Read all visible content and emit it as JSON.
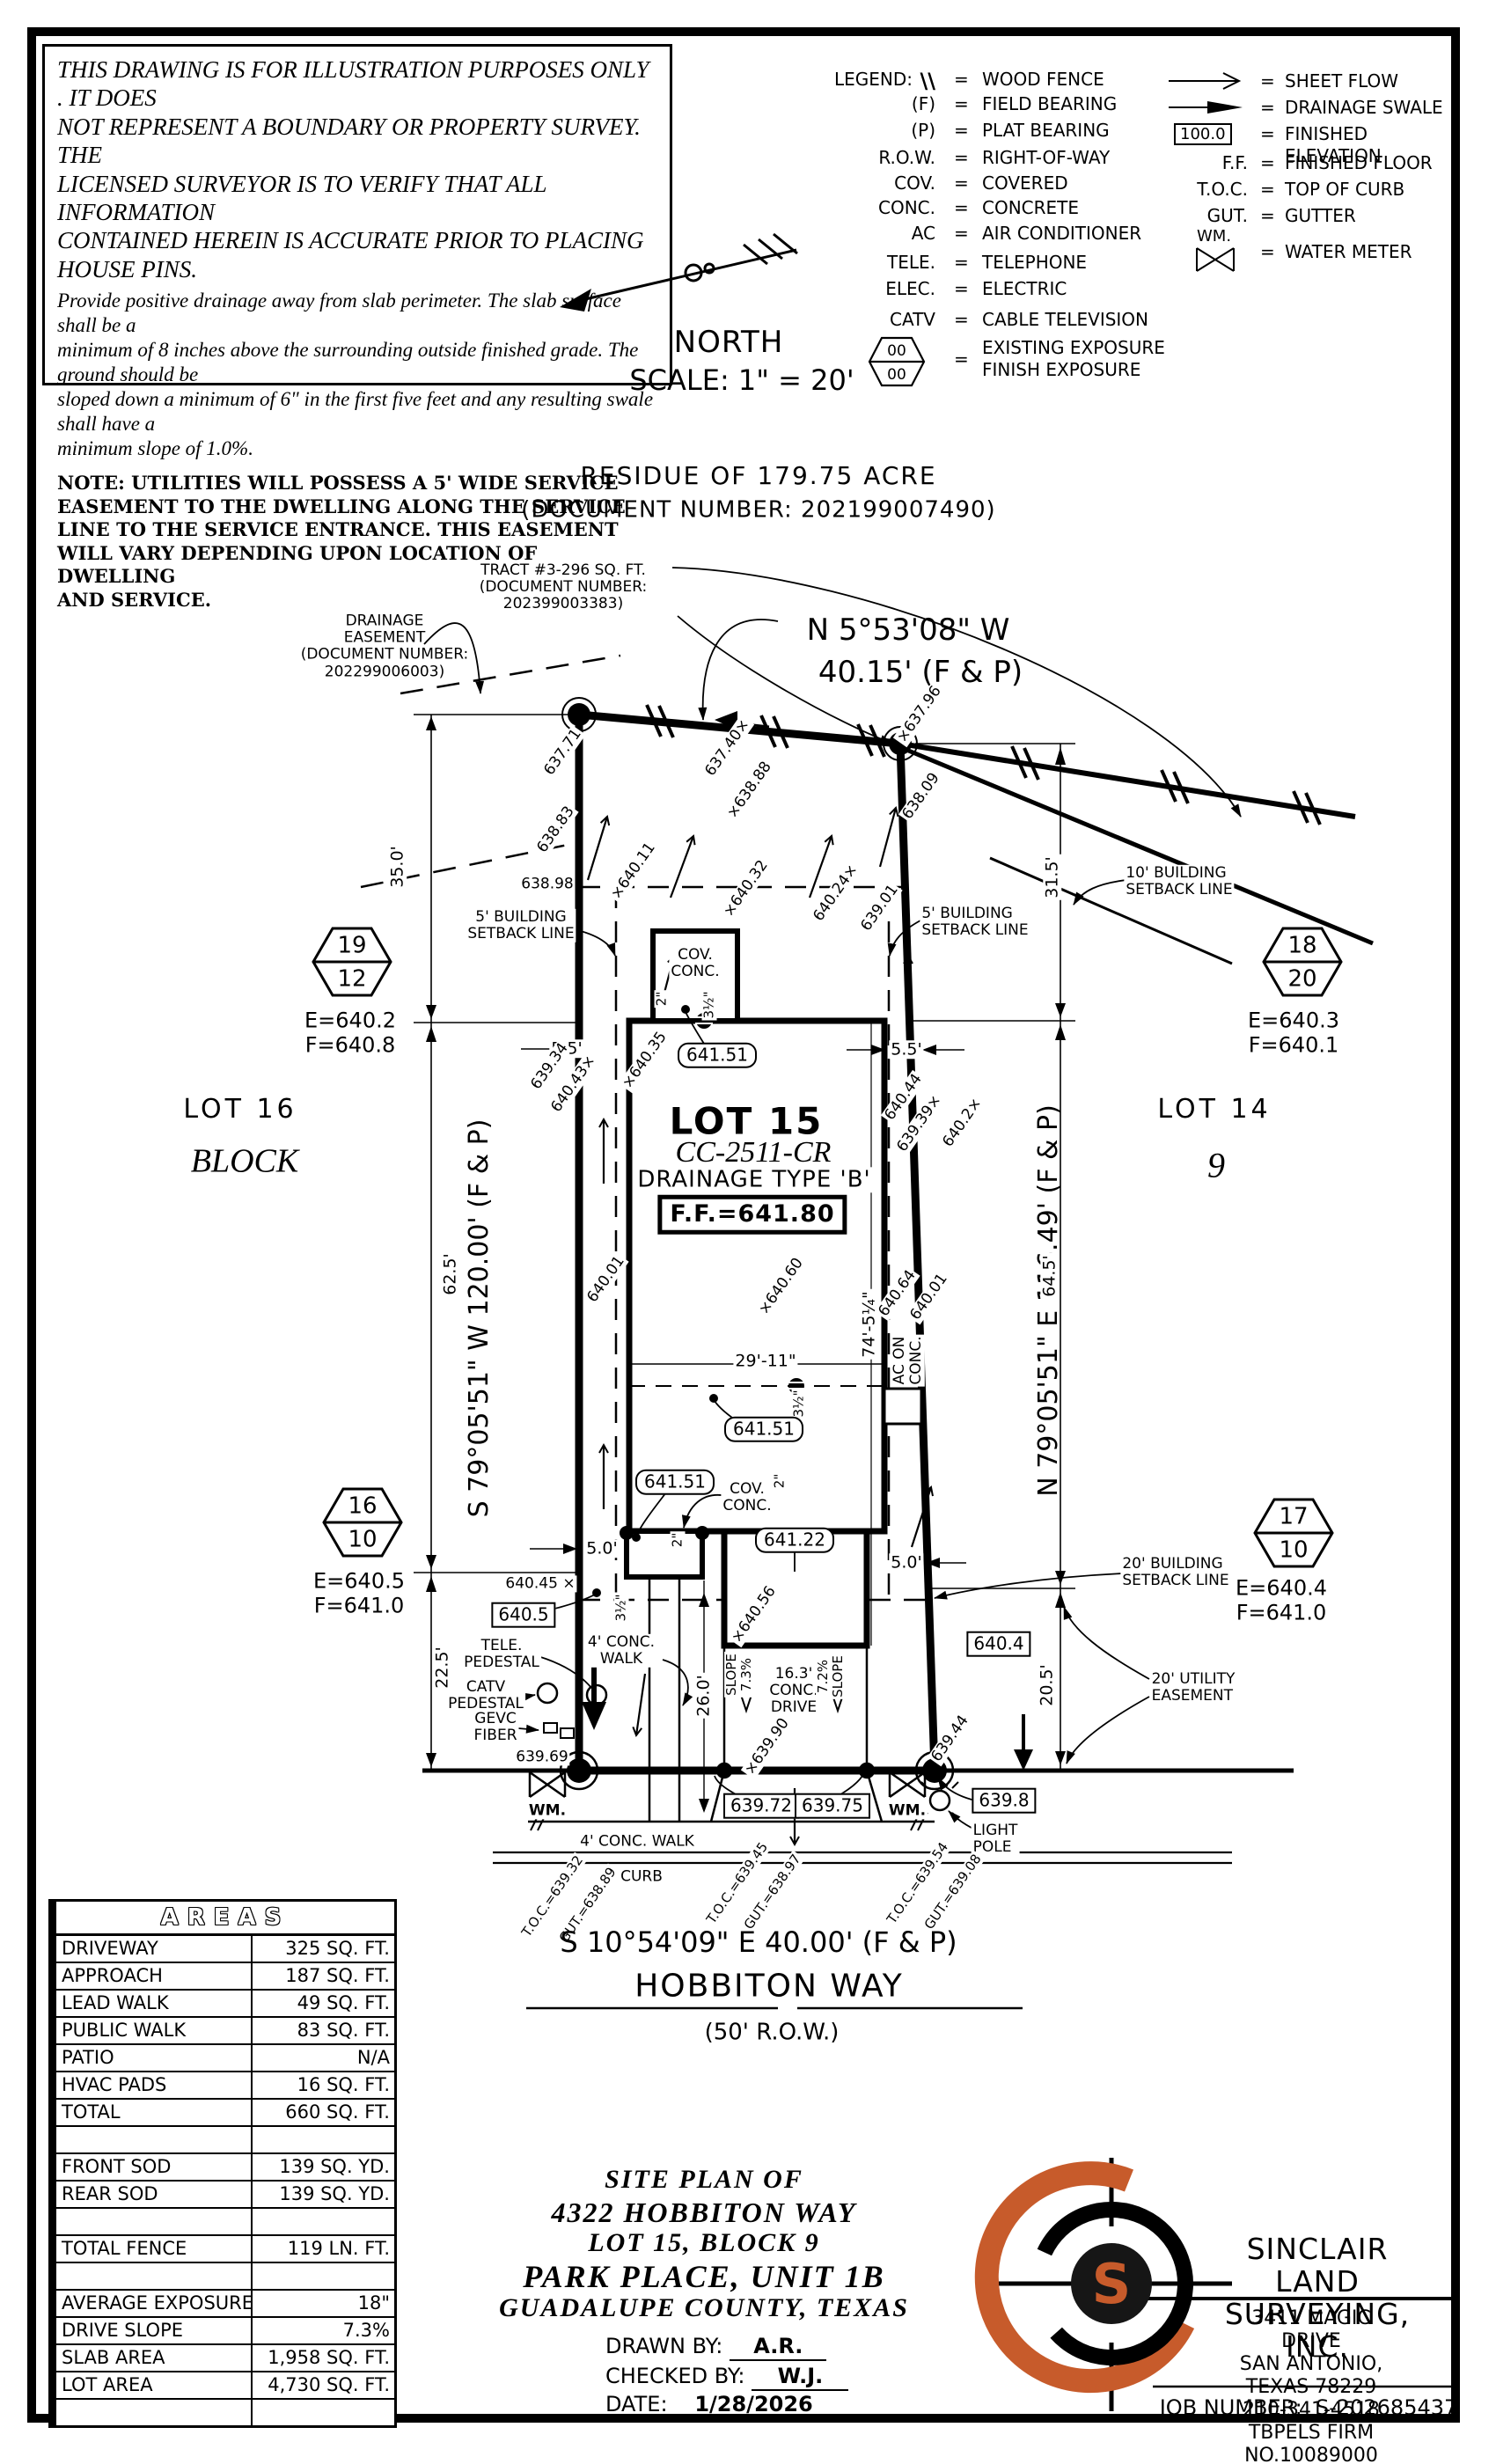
{
  "sheet": {
    "disclaimer_1": "THIS DRAWING IS FOR ILLUSTRATION PURPOSES ONLY . IT DOES\nNOT REPRESENT A BOUNDARY OR PROPERTY SURVEY. THE\nLICENSED SURVEYOR IS TO VERIFY THAT ALL INFORMATION\nCONTAINED HEREIN IS ACCURATE PRIOR TO PLACING HOUSE PINS.",
    "disclaimer_2": "Provide positive drainage away from slab perimeter. The slab surface shall be a\nminimum of 8 inches above the surrounding outside finished grade. The ground should be\nsloped down a minimum of 6\" in the first five feet and any resulting swale shall have a\nminimum slope of 1.0%.",
    "note": "NOTE: UTILITIES WILL POSSESS A 5' WIDE SERVICE\nEASEMENT TO THE DWELLING ALONG THE SERVICE\nLINE TO THE SERVICE ENTRANCE. THIS EASEMENT\nWILL VARY DEPENDING UPON LOCATION OF DWELLING\nAND SERVICE."
  },
  "compass": {
    "north": "NORTH",
    "scale": "SCALE: 1\" = 20'"
  },
  "legend": {
    "title": "LEGEND:",
    "eq": "=",
    "left": [
      {
        "sym": "\\\\",
        "def": "WOOD FENCE"
      },
      {
        "sym": "(F)",
        "def": "FIELD BEARING"
      },
      {
        "sym": "(P)",
        "def": "PLAT BEARING"
      },
      {
        "sym": "R.O.W.",
        "def": "RIGHT-OF-WAY"
      },
      {
        "sym": "COV.",
        "def": "COVERED"
      },
      {
        "sym": "CONC.",
        "def": "CONCRETE"
      },
      {
        "sym": "AC",
        "def": "AIR CONDITIONER"
      },
      {
        "sym": "TELE.",
        "def": "TELEPHONE"
      },
      {
        "sym": "ELEC.",
        "def": "ELECTRIC"
      },
      {
        "sym": "CATV",
        "def": "CABLE TELEVISION"
      }
    ],
    "exposure": {
      "top": "00",
      "bottom": "00",
      "def": "EXISTING EXPOSURE\nFINISH EXPOSURE"
    },
    "right": [
      {
        "sym": "sheet-flow-arrow",
        "def": "SHEET FLOW"
      },
      {
        "sym": "drainage-swale-arrow",
        "def": "DRAINAGE SWALE"
      },
      {
        "sym": "100.0",
        "def": "FINISHED ELEVATION"
      },
      {
        "sym": "F.F.",
        "def": "FINISHED FLOOR"
      },
      {
        "sym": "T.O.C.",
        "def": "TOP OF CURB"
      },
      {
        "sym": "GUT.",
        "def": "GUTTER"
      },
      {
        "sym": "WM.",
        "def": "WATER METER"
      }
    ]
  },
  "header": {
    "residue": "RESIDUE OF 179.75 ACRE",
    "residue_doc": "(DOCUMENT NUMBER: 202199007490)"
  },
  "plan": {
    "tract_callout": "TRACT #3-296 SQ. FT.\n(DOCUMENT NUMBER:\n202399003383)",
    "drainage_easement": "DRAINAGE\nEASEMENT\n(DOCUMENT NUMBER:\n202299006003)",
    "bearing_north_1": "N 5°53'08\" W",
    "bearing_north_2": "40.15' (F & P)",
    "bearing_west": "S 79°05'51\" W 120.00' (F & P)",
    "bearing_east": "N 79°05'51\" E 116.49' (F & P)",
    "street_bearing": "S 10°54'09\" E 40.00' (F & P)",
    "street_name": "HOBBITON WAY",
    "street_row": "(50' R.O.W.)",
    "lot_left_1": "LOT 16",
    "lot_left_2": "BLOCK",
    "lot_right_1": "LOT 14",
    "lot_right_2": "9",
    "lot15_1": "LOT 15",
    "lot15_2": "CC-2511-CR",
    "lot15_3": "DRAINAGE TYPE 'B'",
    "lot15_ff": "F.F.=641.80",
    "setback_5_left": "5' BUILDING\nSETBACK LINE",
    "setback_5_right": "5' BUILDING\nSETBACK LINE",
    "setback_10": "10' BUILDING\nSETBACK LINE",
    "setback_20": "20' BUILDING\nSETBACK LINE",
    "utility_20": "20' UTILITY\nEASEMENT",
    "cov_conc_top": "COV.\nCONC.",
    "cov_conc_mid": "COV.\nCONC.",
    "ac_on_conc": "AC ON\nCONC.",
    "walk_lead": "4' CONC.\nWALK",
    "walk_public": "4' CONC. WALK",
    "drive": "16.3'\nCONC.\nDRIVE",
    "slope_left": "SLOPE\n7.3%",
    "slope_right": "7.2%\nSLOPE",
    "tele_pedestal": "TELE.\nPEDESTAL",
    "catv_pedestal": "CATV\nPEDESTAL",
    "gevc_fiber": "GEVC\nFIBER",
    "light_pole": "LIGHT\nPOLE",
    "curb": "CURB",
    "wm_left": "WM.",
    "wm_right": "WM.",
    "dims": {
      "d35": "35.0'",
      "d315": "31.5'",
      "d625": "62.5'",
      "d645": "64.5'",
      "d225": "22.5'",
      "d205": "20.5'",
      "d55l": "5.5'",
      "d55r": "5.5'",
      "d50l": "5.0'",
      "d50r": "5.0'",
      "d2911": "29'-11\"",
      "d74": "74'-5¼\"",
      "d260": "26.0'",
      "in2a": "2\"",
      "in2b": "2\"",
      "in2c": "2\"",
      "in35a": "3½\"",
      "in35b": "3½\"",
      "in35c": "3½\""
    },
    "spots": [
      "637.71",
      "637.40×",
      "×638.88",
      "×637.96",
      "638.09",
      "638.83",
      "638.98",
      "×640.11",
      "×640.32",
      "640.24×",
      "639.01",
      "639.34",
      "640.43×",
      "×640.35",
      "640.44",
      "639.39×",
      "640.2×",
      "×640.60",
      "640.64",
      "640.01",
      "640.01",
      "640.45 ×",
      "×640.56",
      "639.69",
      "×639.90",
      "639.44"
    ],
    "boxed": [
      "641.51",
      "641.51",
      "641.51",
      "641.22",
      "640.5",
      "640.4",
      "639.72",
      "639.75",
      "639.8"
    ],
    "toc": [
      "T.O.C.=639.32",
      "GUT.=638.89",
      "T.O.C.=639.45",
      "GUT.=638.97",
      "T.O.C.=639.54",
      "GUT.=639.08"
    ]
  },
  "markers": [
    {
      "top": "19",
      "bottom": "12",
      "e": "E=640.2",
      "f": "F=640.8"
    },
    {
      "top": "18",
      "bottom": "20",
      "e": "E=640.3",
      "f": "F=640.1"
    },
    {
      "top": "16",
      "bottom": "10",
      "e": "E=640.5",
      "f": "F=641.0"
    },
    {
      "top": "17",
      "bottom": "10",
      "e": "E=640.4",
      "f": "F=641.0"
    }
  ],
  "areas_table": {
    "title": "AREAS",
    "rows": [
      {
        "l": "DRIVEWAY",
        "v": "325 SQ. FT."
      },
      {
        "l": "APPROACH",
        "v": "187 SQ. FT."
      },
      {
        "l": "LEAD WALK",
        "v": "49 SQ. FT."
      },
      {
        "l": "PUBLIC WALK",
        "v": "83 SQ. FT."
      },
      {
        "l": "PATIO",
        "v": "N/A"
      },
      {
        "l": "HVAC PADS",
        "v": "16 SQ. FT."
      },
      {
        "l": "TOTAL",
        "v": "660 SQ. FT."
      },
      {
        "l": "",
        "v": ""
      },
      {
        "l": "FRONT SOD",
        "v": "139 SQ. YD."
      },
      {
        "l": "REAR SOD",
        "v": "139 SQ. YD."
      },
      {
        "l": "",
        "v": ""
      },
      {
        "l": "TOTAL FENCE",
        "v": "119 LN. FT."
      },
      {
        "l": "",
        "v": ""
      },
      {
        "l": "AVERAGE EXPOSURE",
        "v": "18\""
      },
      {
        "l": "DRIVE SLOPE",
        "v": "7.3%"
      },
      {
        "l": "SLAB AREA",
        "v": "1,958 SQ. FT."
      },
      {
        "l": "LOT AREA",
        "v": "4,730 SQ. FT."
      },
      {
        "l": "",
        "v": ""
      }
    ]
  },
  "title_block": {
    "line1": "SITE PLAN OF",
    "line2": "4322 HOBBITON WAY",
    "line3": "LOT 15, BLOCK 9",
    "line4": "PARK PLACE, UNIT 1B",
    "line5": "GUADALUPE COUNTY, TEXAS",
    "drawn_label": "DRAWN BY:",
    "drawn": "A.R.",
    "checked_label": "CHECKED BY:",
    "checked": "W.J.",
    "date_label": "DATE:",
    "date": "1/28/2026"
  },
  "firm": {
    "name": "SINCLAIR LAND\nSURVEYING, INC.",
    "address": "3411 MAGIC DRIVE\nSAN ANTONIO, TEXAS 78229\n210-341-4518\nTBPELS FIRM NO.10089000",
    "job_label": "JOB NUMBER:",
    "job": "S-202685437",
    "logo_letter": "S",
    "accent": "#C75B2B"
  }
}
